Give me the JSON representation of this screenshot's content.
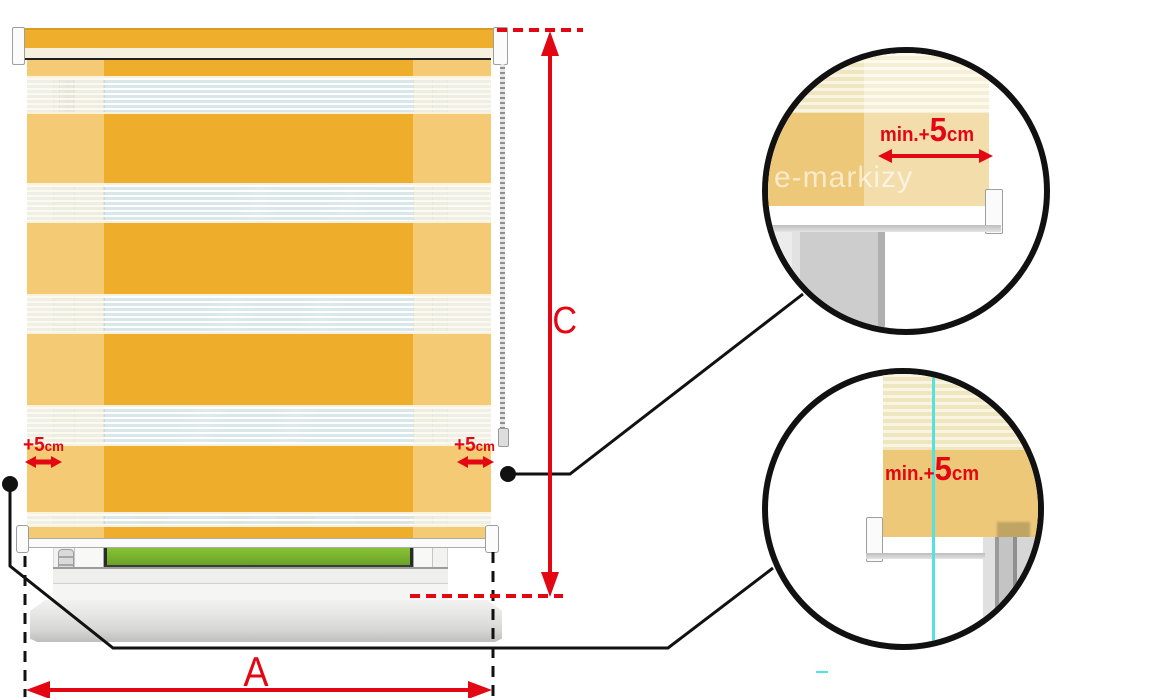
{
  "diagram_title": "Day-night roller blind measurement diagram",
  "labels": {
    "width": "A",
    "height": "C"
  },
  "allowances": {
    "left": {
      "value": "+5",
      "unit": "cm"
    },
    "right": {
      "value": "+5",
      "unit": "cm"
    }
  },
  "details": {
    "top_circle": {
      "label": {
        "prefix": "min.+",
        "value": "5",
        "unit": "cm"
      }
    },
    "bottom_circle": {
      "label": {
        "prefix": "min.+",
        "value": "5",
        "unit": "cm"
      }
    }
  },
  "watermark": "e-markizy",
  "colors": {
    "accent_red": "#E30613",
    "blind_yellow": "#EEAE2B",
    "blind_cream": "#F6F1DE",
    "sheer_band": "#DCE7E8",
    "glass_sky": "#D9E7EA",
    "field_green": "#76B82A",
    "cyan_guide": "#55E1E4",
    "callout_black": "#111111"
  },
  "blind": {
    "bands": [
      {
        "type": "yellow",
        "h": 16
      },
      {
        "type": "sheer",
        "h": 38
      },
      {
        "type": "yellow",
        "h": 69
      },
      {
        "type": "sheer",
        "h": 40
      },
      {
        "type": "yellow",
        "h": 71
      },
      {
        "type": "sheer",
        "h": 40
      },
      {
        "type": "yellow",
        "h": 71
      },
      {
        "type": "sheer",
        "h": 41
      },
      {
        "type": "yellow",
        "h": 66
      },
      {
        "type": "sheer-landscape",
        "h": 15
      },
      {
        "type": "yellow",
        "h": 12
      }
    ]
  }
}
